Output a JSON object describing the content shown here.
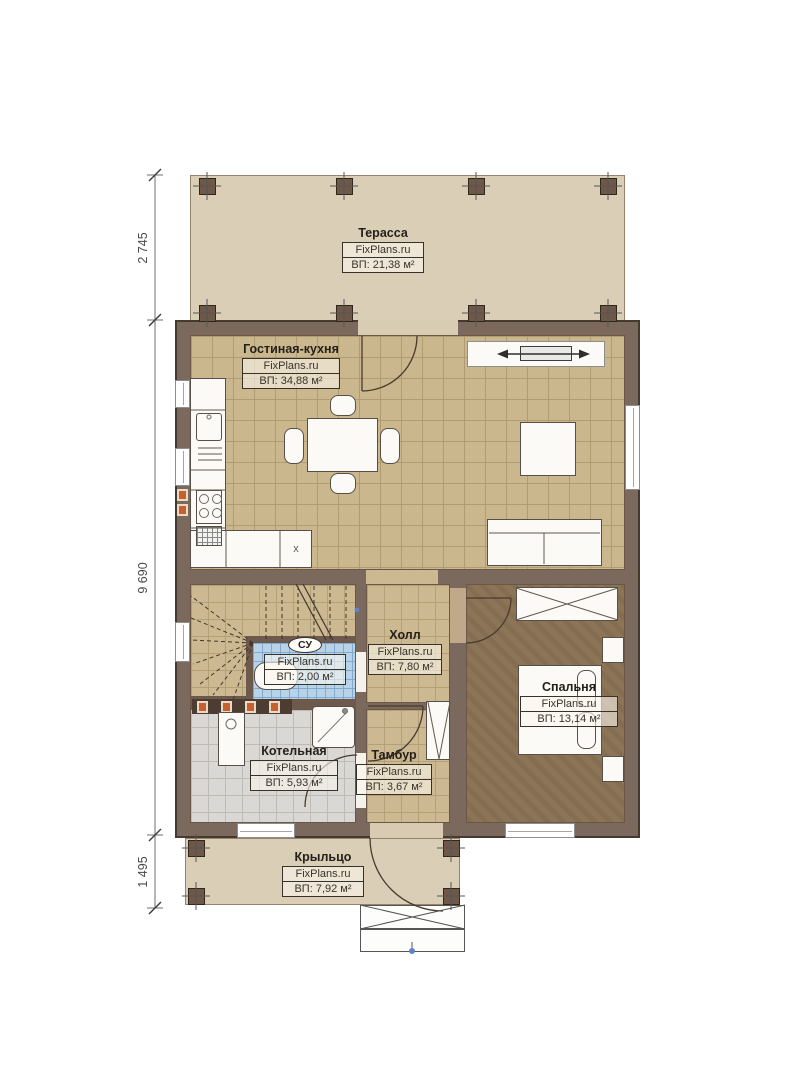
{
  "brand": "FixPlans.ru",
  "rooms": {
    "terrace": {
      "name": "Терасса",
      "area": "ВП: 21,38 м²"
    },
    "living": {
      "name": "Гостиная-кухня",
      "area": "ВП: 34,88 м²"
    },
    "hall": {
      "name": "Холл",
      "area": "ВП: 7,80 м²"
    },
    "bathroom": {
      "name": "СУ",
      "area": "ВП: 2,00 м²"
    },
    "bedroom": {
      "name": "Спальня",
      "area": "ВП: 13,14 м²"
    },
    "boiler": {
      "name": "Котельная",
      "area": "ВП: 5,93 м²"
    },
    "tambour": {
      "name": "Тамбур",
      "area": "ВП: 3,67 м²"
    },
    "porch": {
      "name": "Крыльцо",
      "area": "ВП: 7,92 м²"
    }
  },
  "dimensions": {
    "terrace_depth": "2 745",
    "house_depth": "9 690",
    "porch_depth": "1 495"
  },
  "markers": {
    "kitchen_appliance": "x"
  }
}
